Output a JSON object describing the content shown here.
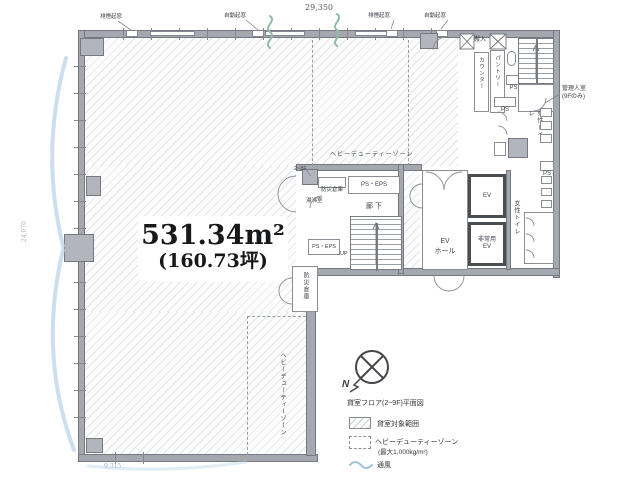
{
  "dims": {
    "top": "29,350",
    "left": "24,070",
    "bottom": "9,315"
  },
  "window_labels": {
    "w1": "排煙起窓",
    "w2": "自動起窓",
    "w3": "排煙起窓",
    "w4": "自動起窓"
  },
  "area": {
    "sqm": "531.34m²",
    "tsubo": "(160.73坪)"
  },
  "zones": {
    "hdz_top": "ヘビーデューティーゾーン",
    "hdz_bottom": "ヘビーデューティーゾーン",
    "door_floors": "2~8F"
  },
  "rooms": {
    "delivery": "搬入",
    "counter": "カウンター",
    "pantry": "パントリー",
    "manager1": "管理人室",
    "manager2": "(9Fのみ)",
    "mens": "男性トイレ",
    "womens": "女性トイレ",
    "corridor": "廊下",
    "ps_eps1": "PS・EPS",
    "ps_eps2": "PS・EPS",
    "ps1": "PS",
    "ps2": "PS",
    "ps3": "PS",
    "fire_box": "防災倉庫",
    "kitchenette": "湯沸室",
    "up": "UP",
    "ev": "EV",
    "em_ev1": "非常用",
    "em_ev2": "EV",
    "hall1": "EV",
    "hall2": "ホール",
    "storage": "防災倉庫"
  },
  "legend": {
    "north": "N",
    "caption": "貸室フロア(2~9F)平面図",
    "item_rental": "貸室対象範囲",
    "item_hdz": "ヘビーデューティーゾーン",
    "item_hdz_sub": "(最大1,000kg/m²)",
    "item_vent": "通風"
  },
  "colors": {
    "wall": "#a5a9af",
    "hatch_line": "#e2e6ea",
    "airflow": "#bdd5e8",
    "vent_green": "#90bda8"
  }
}
